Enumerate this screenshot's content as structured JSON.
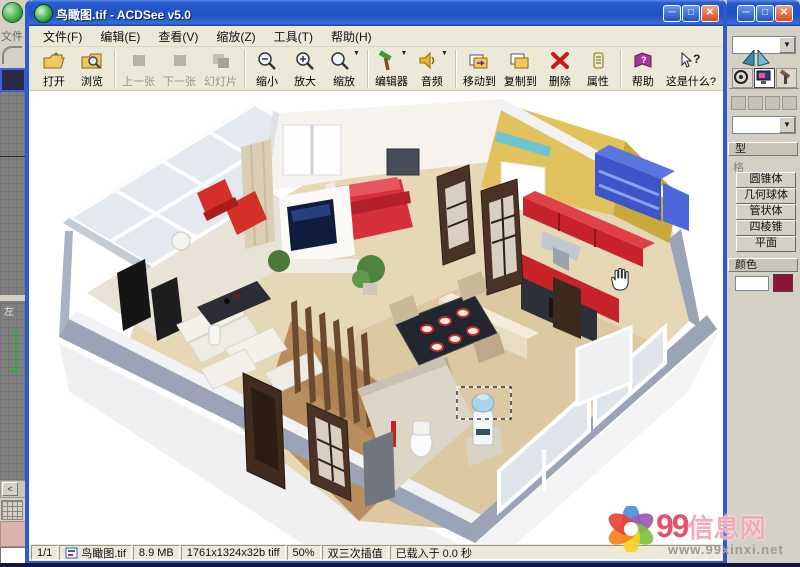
{
  "acdsee": {
    "title": "鸟瞰图.tif - ACDSee v5.0",
    "menu": [
      "文件(F)",
      "编辑(E)",
      "查看(V)",
      "缩放(Z)",
      "工具(T)",
      "帮助(H)"
    ],
    "toolbar": [
      {
        "label": "打开"
      },
      {
        "label": "浏览"
      },
      {
        "label": "上一张",
        "disabled": true
      },
      {
        "label": "下一张",
        "disabled": true
      },
      {
        "label": "幻灯片",
        "disabled": true
      },
      {
        "label": "缩小"
      },
      {
        "label": "放大"
      },
      {
        "label": "缩放",
        "dropdown": true
      },
      {
        "label": "编辑器",
        "dropdown": true
      },
      {
        "label": "音频",
        "dropdown": true
      },
      {
        "label": "移动到"
      },
      {
        "label": "复制到"
      },
      {
        "label": "删除"
      },
      {
        "label": "属性"
      },
      {
        "label": "帮助"
      },
      {
        "label": "这是什么?"
      }
    ],
    "status": {
      "page": "1/1",
      "filename": "鸟瞰图.tif",
      "filesize": "8.9 MB",
      "format": "1761x1324x32b tiff",
      "zoom": "50%",
      "interpolation": "双三次插值",
      "load_time": "已载入于 0.0 秒"
    }
  },
  "background_app": {
    "file_menu": "文件",
    "viewport_label": "左",
    "scroll_arrow": "<",
    "panel": {
      "object_type_fragment": "型",
      "autogrid_fragment": "格",
      "primitives": [
        "圆锥体",
        "几何球体",
        "管状体",
        "四棱锥",
        "平面"
      ],
      "color_fragment": "颜色"
    }
  },
  "watermark": {
    "number": "99",
    "name": "信息网",
    "url": "www.99xinxi.net"
  },
  "palette": {
    "titlebar_blue": "#2a5cd0",
    "window_frame": "#2b5bcf",
    "toolbar_bg": "#ece9d8",
    "panel_bg": "#d4d0c4",
    "swatch_maroon": "#8e1438",
    "kitchen_red": "#c8222a",
    "bed_red": "#d6303a",
    "shelf_blue": "#3d55c8",
    "wall_yellow": "#e2c25c",
    "floor_wood": "#e6d7b6",
    "outer_wall_gray": "#9aa4b6"
  }
}
